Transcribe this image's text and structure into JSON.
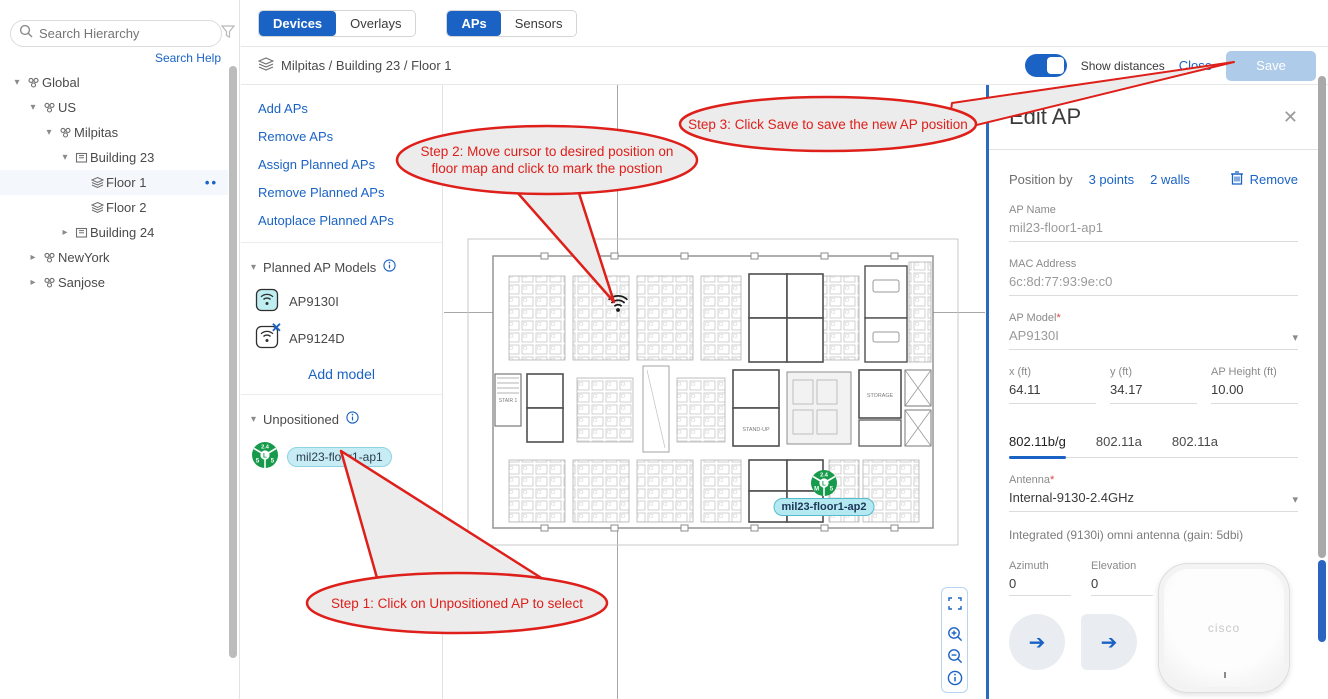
{
  "accent": "#1a63c5",
  "annotation_color": "#de1f1a",
  "sidebar": {
    "search_placeholder": "Search Hierarchy",
    "search_help_label": "Search Help",
    "tree": [
      {
        "label": "Global"
      },
      {
        "label": "US"
      },
      {
        "label": "Milpitas"
      },
      {
        "label": "Building 23"
      },
      {
        "label": "Floor 1"
      },
      {
        "label": "Floor 2"
      },
      {
        "label": "Building 24"
      },
      {
        "label": "NewYork"
      },
      {
        "label": "Sanjose"
      }
    ]
  },
  "topbar": {
    "mode_tabs": [
      {
        "label": "Devices",
        "selected": true
      },
      {
        "label": "Overlays",
        "selected": false
      }
    ],
    "device_tabs": [
      {
        "label": "APs",
        "selected": true
      },
      {
        "label": "Sensors",
        "selected": false
      }
    ]
  },
  "breadcrumb": {
    "path": "Milpitas / Building 23 / Floor 1"
  },
  "header_actions": {
    "show_distances_label": "Show distances",
    "toggle_state": "on",
    "close_label": "Close",
    "save_label": "Save"
  },
  "tools": {
    "links": [
      "Add APs",
      "Remove APs",
      "Assign Planned APs",
      "Remove Planned APs",
      "Autoplace Planned APs"
    ],
    "planned_models": {
      "title": "Planned AP Models",
      "items": [
        "AP9130I",
        "AP9124D"
      ],
      "add_label": "Add model"
    },
    "unpositioned": {
      "title": "Unpositioned",
      "ap_name": "mil23-floor1-ap1"
    }
  },
  "map": {
    "placed_ap_label": "mil23-floor1-ap2",
    "plan_labels": {
      "storage": "STORAGE",
      "standup": "STAND-UP",
      "stair": "STAIR 1"
    },
    "placed_badge": {
      "top": "2.4",
      "left": "M",
      "right": "5",
      "center": "L"
    },
    "unpositioned_badge": {
      "top": "2.4",
      "left": "5",
      "right": "5",
      "center": "L"
    }
  },
  "annotations": {
    "step1": "Step 1: Click on Unpositioned AP to select",
    "step2_line1": "Step 2: Move cursor to desired position on",
    "step2_line2": "floor map and click to mark the postion",
    "step3": "Step 3: Click Save to save the new AP position"
  },
  "edit_panel": {
    "title": "Edit AP",
    "position_by_label": "Position by",
    "points_link": "3 points",
    "walls_link": "2 walls",
    "remove_label": "Remove",
    "required_mark": "*",
    "fields": {
      "ap_name_label": "AP Name",
      "ap_name_value": "mil23-floor1-ap1",
      "mac_label": "MAC Address",
      "mac_value": "6c:8d:77:93:9e:c0",
      "model_label": "AP Model",
      "model_value": "AP9130I",
      "x_label": "x (ft)",
      "x_value": "64.11",
      "y_label": "y (ft)",
      "y_value": "34.17",
      "height_label": "AP Height (ft)",
      "height_value": "10.00"
    },
    "radio_tabs": [
      "802.11b/g",
      "802.11a",
      "802.11a"
    ],
    "antenna_label": "Antenna",
    "antenna_value": "Internal-9130-2.4GHz",
    "antenna_desc": "Integrated (9130i) omni antenna (gain: 5dbi)",
    "azimuth_label": "Azimuth",
    "azimuth_value": "0",
    "elevation_label": "Elevation",
    "elevation_value": "0",
    "ap_image_text": "cisco"
  }
}
